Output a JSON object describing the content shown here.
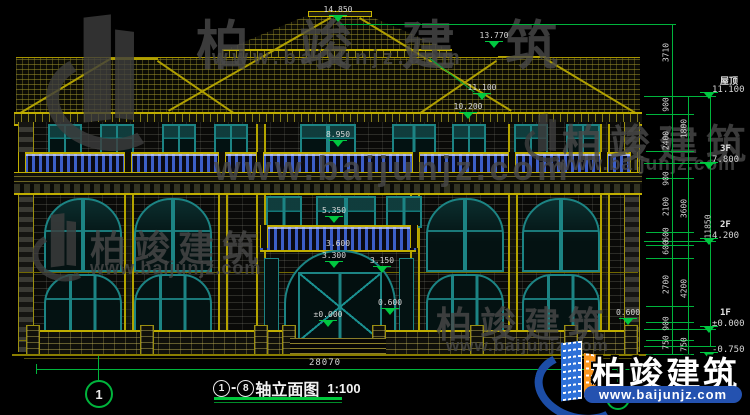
{
  "title": {
    "axis_from": "1",
    "axis_to": "8",
    "text": "轴立面图",
    "scale": "1:100"
  },
  "axes": {
    "left": "1",
    "right": "8"
  },
  "dims": {
    "overall": "28070"
  },
  "watermark": {
    "brand": "柏竣建筑",
    "url": "www.baijunjz.com"
  },
  "logo": {
    "brand": "柏竣建筑",
    "url": "www.baijunjz.com"
  },
  "colors": {
    "dim_green": "#00b43c",
    "line_yellow": "#b4a400",
    "frame_teal": "#1c8484",
    "baluster_blue": "#3c5ec8",
    "logo_blue": "#2452b0",
    "logo_orange": "#f8951e"
  },
  "elevation_markers": [
    {
      "v": "14.850",
      "x": 338,
      "y": 16
    },
    {
      "v": "13.770",
      "x": 494,
      "y": 42
    },
    {
      "v": "11.100",
      "x": 482,
      "y": 94
    },
    {
      "v": "10.200",
      "x": 468,
      "y": 113
    },
    {
      "v": "8.950",
      "x": 338,
      "y": 141
    },
    {
      "v": "5.350",
      "x": 334,
      "y": 217
    },
    {
      "v": "3.600",
      "x": 338,
      "y": 250,
      "nt": 1
    },
    {
      "v": "3.300",
      "x": 334,
      "y": 262
    },
    {
      "v": "3.150",
      "x": 382,
      "y": 267
    },
    {
      "v": "0.600",
      "x": 390,
      "y": 309
    },
    {
      "v": "±0.000",
      "x": 328,
      "y": 321
    },
    {
      "v": "0.600",
      "x": 628,
      "y": 319
    }
  ],
  "right_labels": [
    {
      "l": "屋顶",
      "e": "11.100",
      "y": 74
    },
    {
      "l": "3F",
      "e": "7.800",
      "y": 144
    },
    {
      "l": "2F",
      "e": "4.200",
      "y": 220
    },
    {
      "l": "1F",
      "e": "±0.000",
      "y": 308
    },
    {
      "l": "",
      "e": "-0.750",
      "y": 334
    }
  ],
  "dim_chains": [
    {
      "x": 666,
      "items": [
        {
          "v": "3710",
          "y": 52
        },
        {
          "v": "900",
          "y": 104
        },
        {
          "v": "2400",
          "y": 140
        },
        {
          "v": "900",
          "y": 178
        },
        {
          "v": "2100",
          "y": 206
        },
        {
          "v": "600",
          "y": 234
        },
        {
          "v": "600",
          "y": 247
        },
        {
          "v": "2700",
          "y": 284
        },
        {
          "v": "900",
          "y": 323
        },
        {
          "v": "750",
          "y": 342
        }
      ]
    },
    {
      "x": 684,
      "items": [
        {
          "v": "1800",
          "y": 128
        },
        {
          "v": "3600",
          "y": 208
        },
        {
          "v": "4200",
          "y": 288
        },
        {
          "v": "750",
          "y": 344
        }
      ]
    },
    {
      "x": 708,
      "items": [
        {
          "v": "11850",
          "y": 226
        }
      ]
    }
  ]
}
